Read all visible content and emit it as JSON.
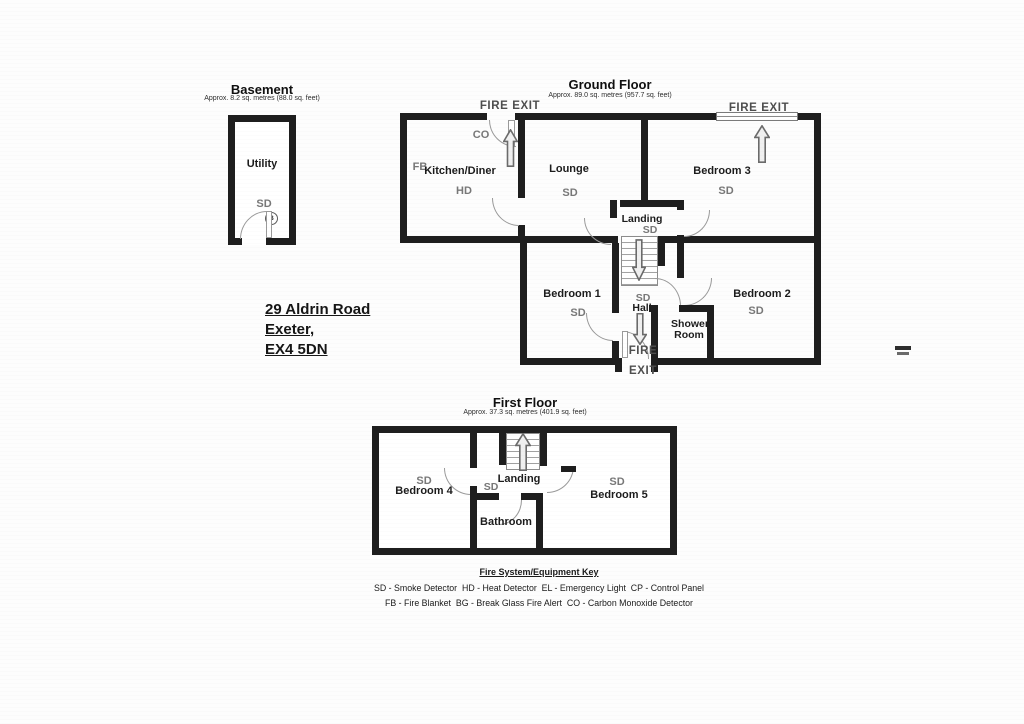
{
  "address": {
    "line1": "29 Aldrin Road",
    "line2": "Exeter,",
    "line3": "EX4 5DN"
  },
  "basement": {
    "title": "Basement",
    "subtitle": "Approx. 8.2 sq. metres (88.0 sq. feet)",
    "utility": "Utility",
    "sd": "SD",
    "boiler": "B"
  },
  "ground": {
    "title": "Ground Floor",
    "subtitle": "Approx. 89.0 sq. metres (957.7 sq. feet)",
    "fire_exit_top_left": "FIRE EXIT",
    "fire_exit_top_right": "FIRE EXIT",
    "fire_exit_bottom": {
      "line1": "FIRE",
      "line2": "EXIT"
    },
    "kitchen": {
      "name": "Kitchen/Diner",
      "co": "CO",
      "fb": "FB",
      "hd": "HD"
    },
    "lounge": {
      "name": "Lounge",
      "sd": "SD"
    },
    "bedroom3": {
      "name": "Bedroom 3",
      "sd": "SD"
    },
    "landing": {
      "name": "Landing",
      "sd": "SD"
    },
    "bedroom1": {
      "name": "Bedroom 1",
      "sd": "SD"
    },
    "hall": {
      "name": "Hall",
      "sd": "SD"
    },
    "bedroom2": {
      "name": "Bedroom 2",
      "sd": "SD"
    },
    "shower": {
      "line1": "Shower",
      "line2": "Room"
    }
  },
  "first": {
    "title": "First Floor",
    "subtitle": "Approx. 37.3 sq. metres (401.9 sq. feet)",
    "bedroom4": {
      "name": "Bedroom 4",
      "sd": "SD"
    },
    "landing": {
      "name": "Landing",
      "sd": "SD"
    },
    "bathroom": {
      "name": "Bathroom"
    },
    "bedroom5": {
      "name": "Bedroom 5",
      "sd": "SD"
    }
  },
  "key": {
    "title": "Fire System/Equipment Key",
    "line1": "SD - Smoke Detector  HD - Heat Detector  EL - Emergency Light  CP - Control Panel",
    "line2": "FB - Fire Blanket  BG - Break Glass Fire Alert  CO - Carbon Monoxide Detector"
  },
  "colors": {
    "wall": "#1e1e1e",
    "gray_label": "#787878",
    "fire_exit_text": "#4e4e4e",
    "arrow_outline": "#6b6b6b"
  }
}
